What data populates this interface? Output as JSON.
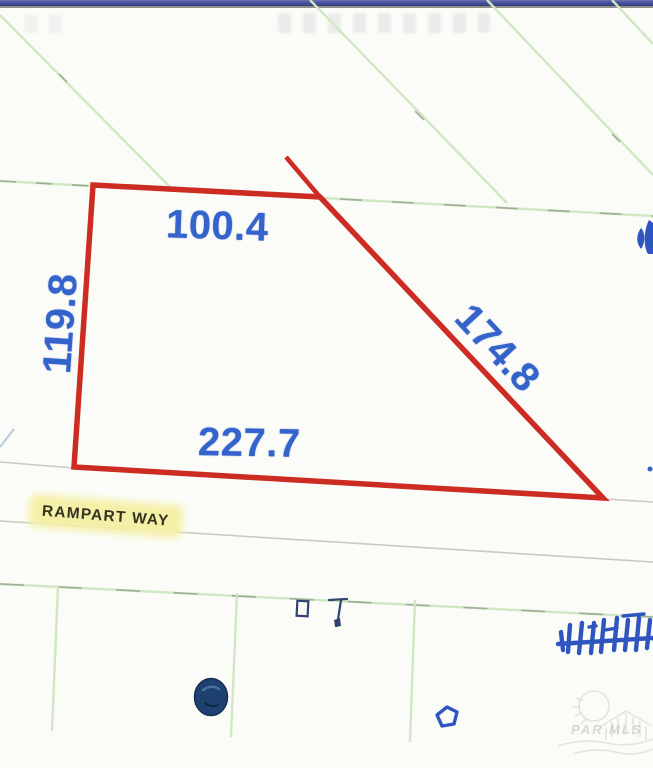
{
  "window": {
    "titlebar_color": "#46539b"
  },
  "map": {
    "parcel": {
      "dimension_top": "100.4",
      "dimension_left": "119.8",
      "dimension_right": "174.8",
      "dimension_bottom": "227.7",
      "outline_color": "#cd2c23",
      "dimension_text_color": "#3463cb"
    },
    "street": {
      "name": "RAMPART WAY",
      "highlight_color": "#f5f0a8"
    },
    "lot_line_color": "#cfe8c3",
    "street_line_color": "#c9c9c4",
    "annotation_color": "#2e55c0",
    "watermark": {
      "text": "PAR MLS"
    }
  }
}
